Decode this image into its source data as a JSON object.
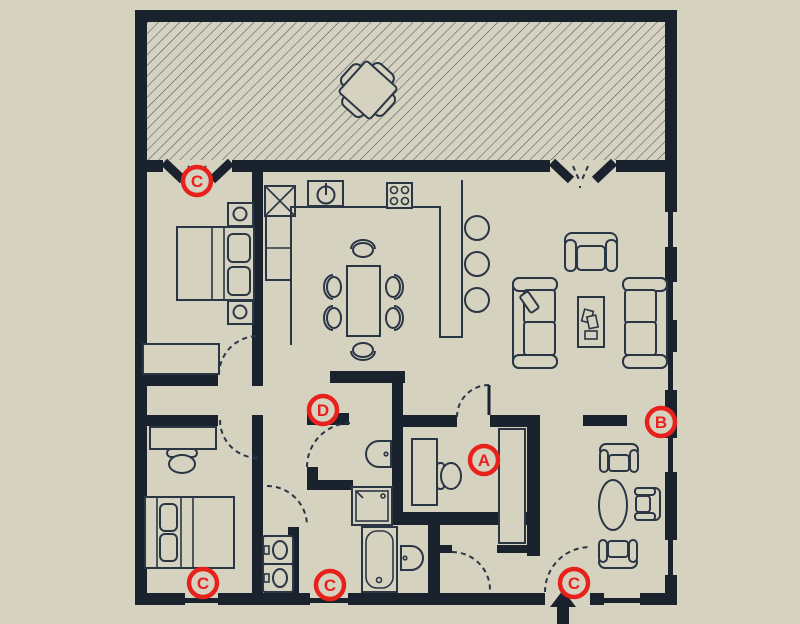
{
  "scene": {
    "kind": "architectural-floor-plan",
    "annotation_markers_note": "red circled letters placed on plan",
    "entrance_arrow": "bottom center, pointing up into dwelling"
  },
  "colors": {
    "background": "#d6d2c0",
    "wall": "#1a222e",
    "line": "#2b3645",
    "hatch": "#4a5360",
    "red": "#e8211d"
  },
  "markers": [
    {
      "label": "C",
      "x": 197,
      "y": 181
    },
    {
      "label": "D",
      "x": 323,
      "y": 410
    },
    {
      "label": "A",
      "x": 484,
      "y": 460
    },
    {
      "label": "B",
      "x": 661,
      "y": 422
    },
    {
      "label": "C",
      "x": 203,
      "y": 583
    },
    {
      "label": "C",
      "x": 330,
      "y": 585
    },
    {
      "label": "C",
      "x": 574,
      "y": 583
    }
  ]
}
